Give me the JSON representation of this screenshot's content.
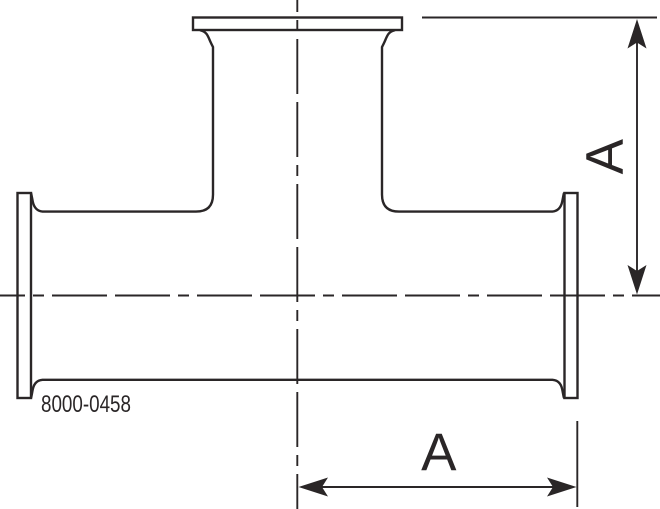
{
  "drawing": {
    "type": "technical-drawing",
    "subject": "clamp-tee-fitting",
    "part_number": "8000-0458",
    "dimensions": {
      "vertical_label": "A",
      "horizontal_label": "A"
    },
    "colors": {
      "line": "#2a2627",
      "background": "#ffffff"
    }
  }
}
